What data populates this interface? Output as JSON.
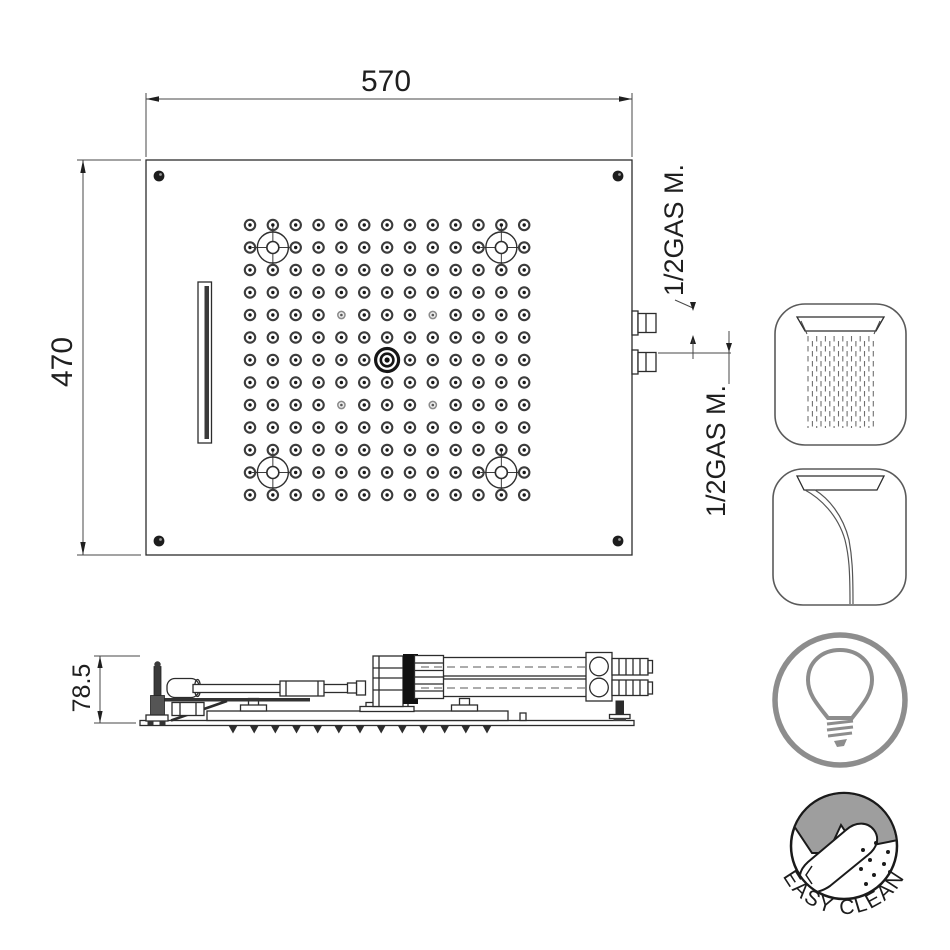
{
  "drawing": {
    "line_color": "#2c2c2c",
    "dim_color": "#3f3f3f",
    "icon_gray": "#8d8d8d",
    "badge_fill_gray": "#9e9e9e"
  },
  "top_view": {
    "width_dim": "570",
    "height_dim": "470",
    "connections": [
      {
        "label": "1/2GAS M."
      },
      {
        "label": "1/2GAS M."
      }
    ],
    "nozzle_grid": {
      "rows": 13,
      "cols": 13,
      "x0": 250,
      "y0": 225,
      "dx": 22.85,
      "dy": 22.5,
      "crosshair_cells": [
        [
          2,
          2
        ],
        [
          2,
          12
        ],
        [
          12,
          2
        ],
        [
          12,
          12
        ]
      ],
      "small_cells": [
        [
          5,
          5
        ],
        [
          5,
          9
        ],
        [
          9,
          5
        ],
        [
          9,
          9
        ]
      ],
      "center_cell": [
        7,
        7
      ]
    }
  },
  "side_view": {
    "height_dim": "78.5",
    "nozzle_teeth": 13
  },
  "feature_icons": [
    {
      "name": "rain-shower-icon"
    },
    {
      "name": "waterfall-icon"
    },
    {
      "name": "light-bulb-icon"
    }
  ],
  "badge": {
    "text": "EASY CLEAN"
  }
}
